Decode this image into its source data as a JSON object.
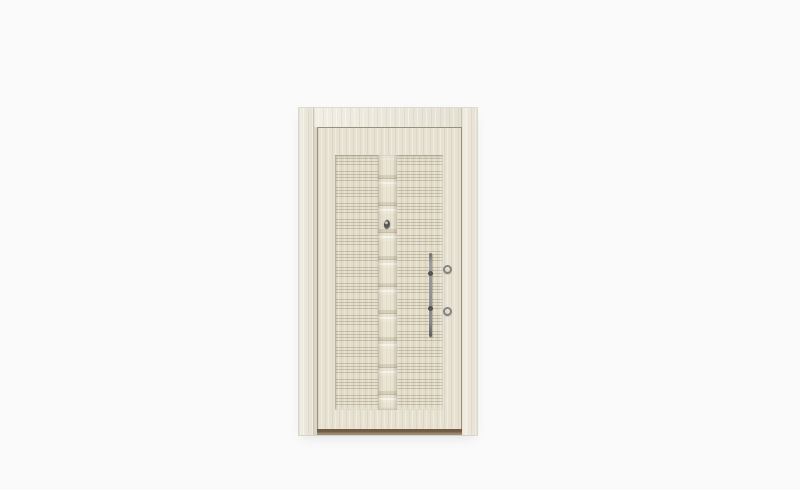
{
  "page": {
    "background": "#fafafa",
    "content": "product photograph only, no visible text"
  },
  "product_image": {
    "alt": "Cream ash-wood laminate security door with outer casing frame, ribbed centre panel, segmented centre column relief, peephole viewer, long vertical bar pull handle, two round lock cylinders and a brown bottom threshold, shown on a plain white background",
    "colors": {
      "background": "#fafafa",
      "frame": "#ece8dc",
      "frame-edge": "#b9b09a",
      "leaf": "#e7e1d1",
      "leaf-outline": "#9a9079",
      "panel": "#e2dcc9",
      "groove": "#7d7056",
      "column": "#eae4d3",
      "threshold-dark": "#6f5a43",
      "threshold-light": "#a68d6f",
      "handle": "#8a8a8a",
      "hardware-dark": "#55524d"
    },
    "parts": {
      "frame": "outer casing frame (left, right, top boards)",
      "leaf": "door leaf with dark outline",
      "panel": "recessed centre panel with horizontal groove bands",
      "column": "segmented vertical relief column",
      "peephole": "door viewer",
      "handle": "vertical bar pull handle with two standoffs",
      "cylinders": [
        "upper lock cylinder",
        "lower lock cylinder"
      ],
      "threshold": "brown bottom sill"
    }
  }
}
